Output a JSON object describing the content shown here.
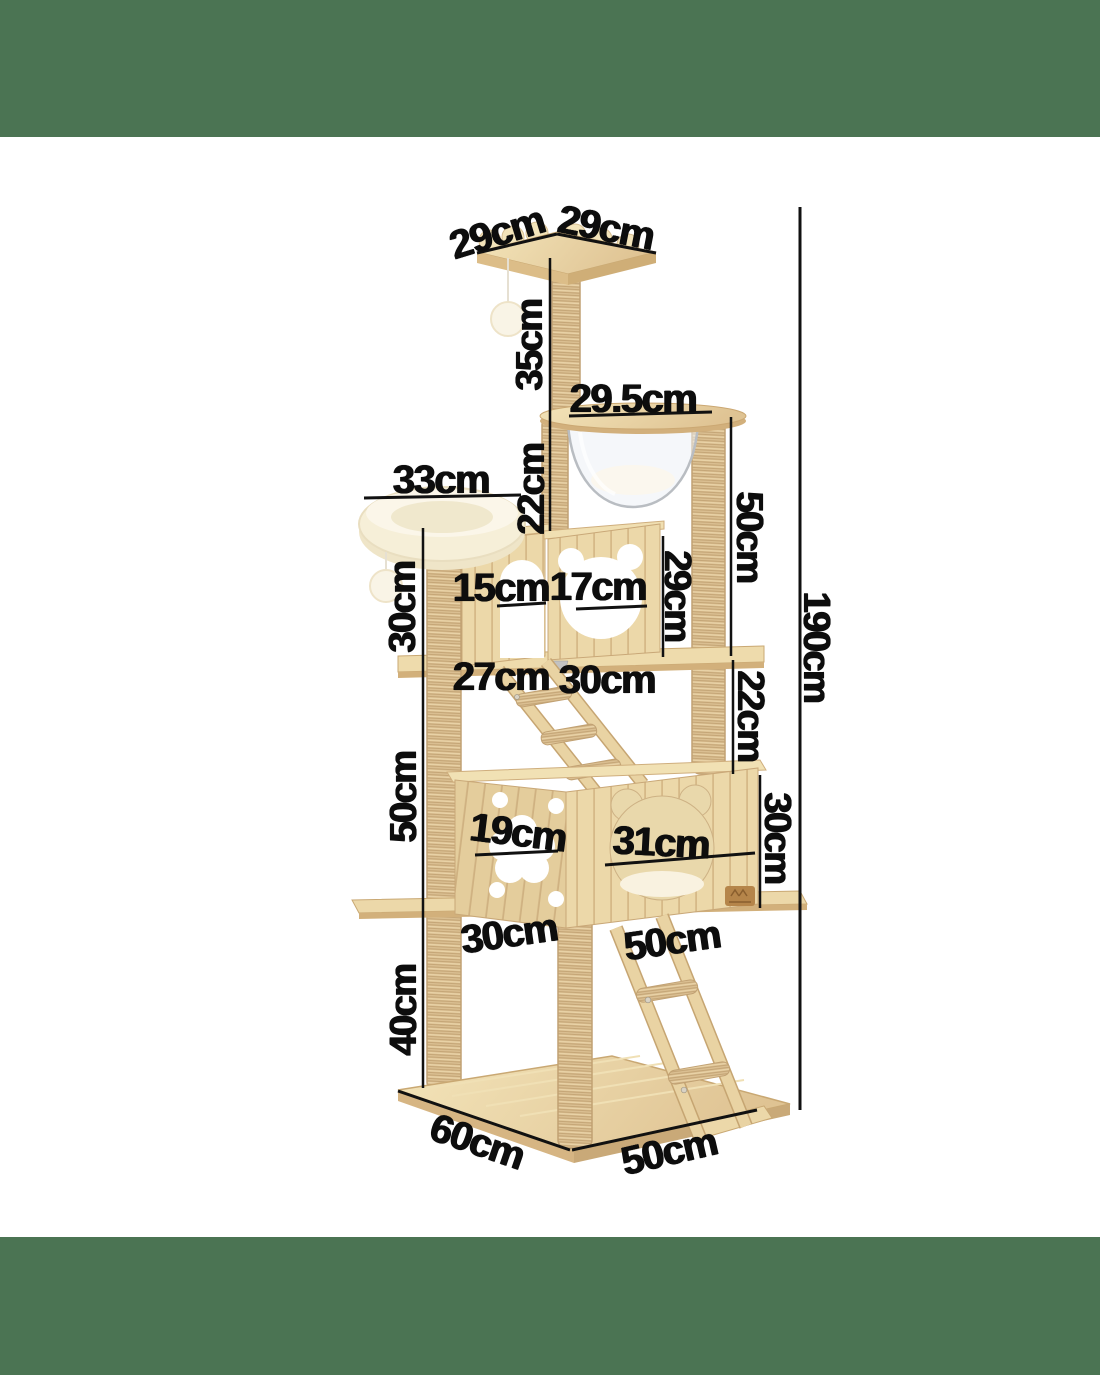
{
  "page": {
    "description": "Cat tree / cat tower dimension diagram on white background with green bars",
    "colors": {
      "banner": "#4b7453",
      "background": "#ffffff",
      "label_text": "#0d0d0d",
      "dimension_line": "#111111",
      "wood": "#ecd8a9",
      "wood_dark": "#d6b988",
      "sisal_post": "#ddc295",
      "plush": "#f6efd8",
      "capsule_outline": "#b9bdc2"
    }
  },
  "product": {
    "name": "cat-tree",
    "visible_parts": [
      "scalloped-top-perch",
      "hanging-pompom-top",
      "clear-capsule-bowl-platform",
      "plush-round-bed",
      "hanging-pompom-bed",
      "cube-house-arch-window",
      "cube-house-bear-window",
      "middle-shelf",
      "upper-ramp-ladder",
      "double-condo-box-flower-hole",
      "double-condo-box-cat-head-hole",
      "brand-logo",
      "lower-shelf",
      "lower-ladder",
      "base-platform",
      "sisal-posts"
    ]
  },
  "dimensions": {
    "total_height": "190cm",
    "labels": [
      {
        "id": "top-platform-depth",
        "text": "29cm"
      },
      {
        "id": "top-platform-width",
        "text": "29cm"
      },
      {
        "id": "top-post-height",
        "text": "35cm"
      },
      {
        "id": "capsule-platform-width",
        "text": "29.5cm"
      },
      {
        "id": "plush-bed-width",
        "text": "33cm"
      },
      {
        "id": "capsule-to-cube-gap",
        "text": "22cm"
      },
      {
        "id": "capsule-to-shelf-height",
        "text": "50cm"
      },
      {
        "id": "bed-post-height",
        "text": "30cm"
      },
      {
        "id": "arch-window-width",
        "text": "15cm"
      },
      {
        "id": "bear-window-width",
        "text": "17cm"
      },
      {
        "id": "cube-house-height",
        "text": "29cm"
      },
      {
        "id": "shelf-left-depth",
        "text": "27cm"
      },
      {
        "id": "shelf-right-depth",
        "text": "30cm"
      },
      {
        "id": "shelf-to-condo-gap",
        "text": "22cm"
      },
      {
        "id": "mid-post-height",
        "text": "50cm"
      },
      {
        "id": "flower-hole-width",
        "text": "19cm"
      },
      {
        "id": "cat-hole-width",
        "text": "31cm"
      },
      {
        "id": "condo-height",
        "text": "30cm"
      },
      {
        "id": "lower-shelf-depth",
        "text": "30cm"
      },
      {
        "id": "condo-width",
        "text": "50cm"
      },
      {
        "id": "base-post-height",
        "text": "40cm"
      },
      {
        "id": "base-depth",
        "text": "60cm"
      },
      {
        "id": "base-width",
        "text": "50cm"
      },
      {
        "id": "total-height",
        "text": "190cm"
      }
    ]
  }
}
